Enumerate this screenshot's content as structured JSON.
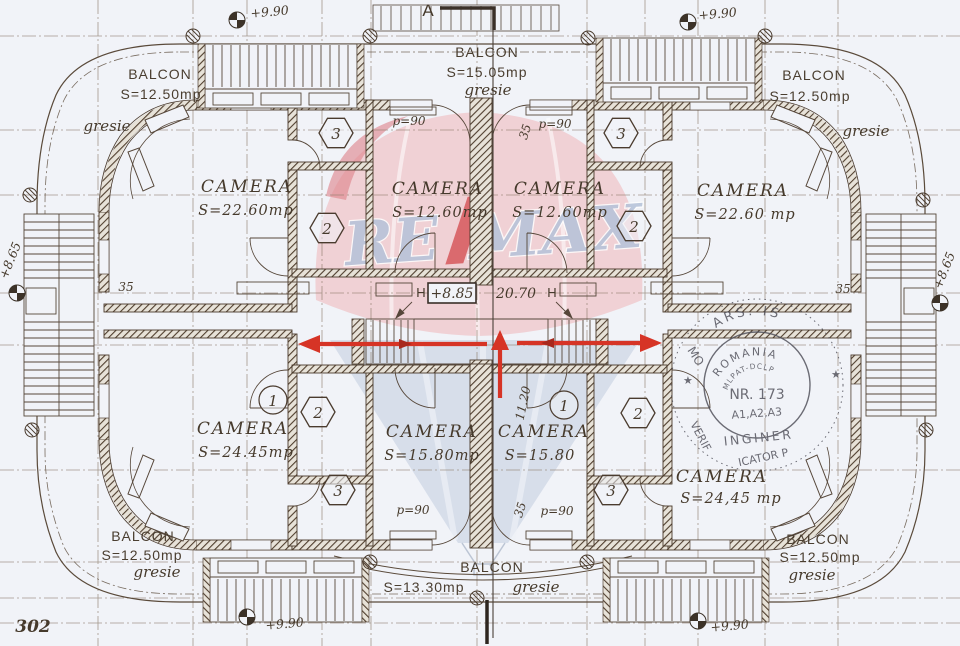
{
  "page_number": "302",
  "section_label": "A",
  "watermark": {
    "re": "RE",
    "max": "MAX"
  },
  "balconies": {
    "top_left": {
      "title": "BALCON",
      "area": "S=12.50mp",
      "finish": "gresie"
    },
    "top_center": {
      "title": "BALCON",
      "area": "S=15.05mp",
      "finish": "gresie"
    },
    "top_right": {
      "title": "BALCON",
      "area": "S=12.50mp",
      "finish": "gresie"
    },
    "bottom_left": {
      "title": "BALCON",
      "area": "S=12.50mp",
      "finish": "gresie"
    },
    "bottom_center": {
      "title": "BALCON",
      "area": "S=13.30mp",
      "finish": "gresie"
    },
    "bottom_right": {
      "title": "BALCON",
      "area": "S=12.50mp",
      "finish": "gresie"
    }
  },
  "rooms": {
    "top_left": {
      "title": "CAMERA",
      "area": "S=22.60mp"
    },
    "top_center_left": {
      "title": "CAMERA",
      "area": "S=12.60mp"
    },
    "top_center_right": {
      "title": "CAMERA",
      "area": "S=12.60mp"
    },
    "top_right": {
      "title": "CAMERA",
      "area": "S=22.60 mp"
    },
    "bottom_left": {
      "title": "CAMERA",
      "area": "S=24.45mp"
    },
    "bottom_center_left": {
      "title": "CAMERA",
      "area": "S=15.80mp"
    },
    "bottom_center_right": {
      "title": "CAMERA",
      "area": "S=15.80"
    },
    "bottom_right": {
      "title": "CAMERA",
      "area": "S=24,45 mp"
    }
  },
  "levels": {
    "roof_top_left": "+9.90",
    "roof_top_right": "+9.90",
    "roof_bottom_left": "+9.90",
    "roof_bottom_right": "+9.90",
    "stair_left": "+8.65",
    "stair_right": "+8.65",
    "landing": "+8.85"
  },
  "dimensions": {
    "corridor": "20.70",
    "stair_run": "11.20",
    "wall": "35"
  },
  "doors": {
    "width_label": "p=90"
  },
  "space_markers": {
    "one": "1",
    "two": "2",
    "three": "3"
  },
  "radiator_label": "H",
  "stamp": {
    "outer_top": "ARS. IS",
    "outer_left": "MO",
    "outer_bottom_left": "VERIF",
    "outer_bottom": "ICATOR  P",
    "country": "ROMANIA",
    "authority": "MLPAT-DCLP",
    "number": "NR. 173",
    "categories": "A1,A2,A3",
    "title": "INGINER",
    "star": "★"
  },
  "colors": {
    "ink": "#4a3b2e",
    "arrow_red": "#d63426",
    "balloon_pink": "#efc7cb",
    "balloon_blue": "#c6d0e2",
    "letters_blue": "#b5c2d9",
    "stamp_ink": "#4e4e58"
  }
}
